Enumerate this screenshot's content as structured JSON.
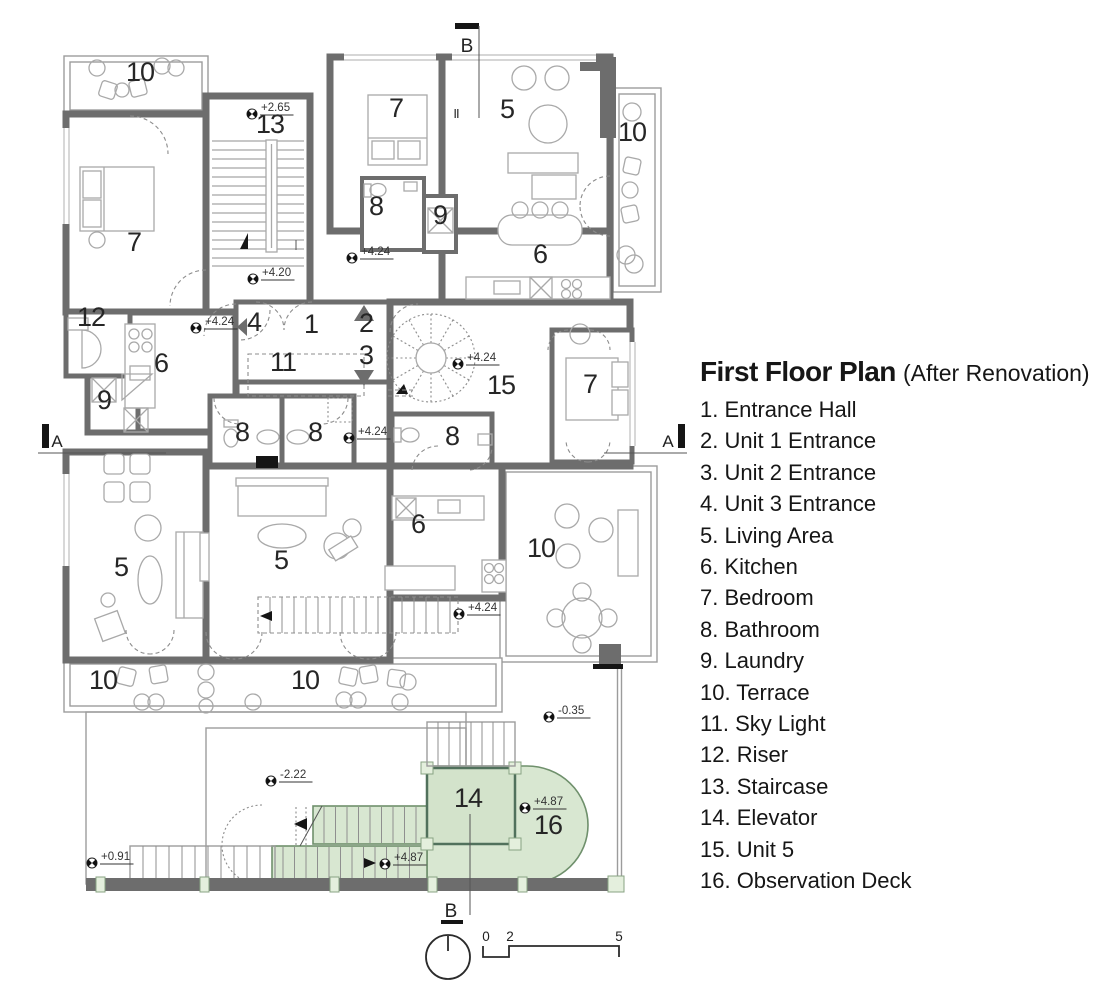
{
  "title": {
    "main": "First Floor Plan",
    "sub": "(After Renovation)"
  },
  "legend_items": [
    {
      "num": "1",
      "label": "Entrance Hall"
    },
    {
      "num": "2",
      "label": "Unit 1 Entrance"
    },
    {
      "num": "3",
      "label": "Unit 2 Entrance"
    },
    {
      "num": "4",
      "label": "Unit 3 Entrance"
    },
    {
      "num": "5",
      "label": "Living Area"
    },
    {
      "num": "6",
      "label": "Kitchen"
    },
    {
      "num": "7",
      "label": "Bedroom"
    },
    {
      "num": "8",
      "label": "Bathroom"
    },
    {
      "num": "9",
      "label": "Laundry"
    },
    {
      "num": "10",
      "label": "Terrace"
    },
    {
      "num": "11",
      "label": "Sky Light"
    },
    {
      "num": "12",
      "label": "Riser"
    },
    {
      "num": "13",
      "label": "Staircase"
    },
    {
      "num": "14",
      "label": "Elevator"
    },
    {
      "num": "15",
      "label": "Unit 5"
    },
    {
      "num": "16",
      "label": "Observation Deck"
    }
  ],
  "colors": {
    "wall": "#6d6d6d",
    "green_fill": "#d8e7d1",
    "green_line": "#6f906c",
    "text": "#161616"
  },
  "plan": {
    "room_labels": [
      {
        "t": "10",
        "x": 140,
        "y": 81
      },
      {
        "t": "13",
        "x": 270,
        "y": 133
      },
      {
        "t": "7",
        "x": 396,
        "y": 117
      },
      {
        "t": "5",
        "x": 507,
        "y": 118
      },
      {
        "t": "II",
        "x": 456,
        "y": 118,
        "s": 13
      },
      {
        "t": "10",
        "x": 632,
        "y": 141
      },
      {
        "t": "7",
        "x": 134,
        "y": 251
      },
      {
        "t": "8",
        "x": 376,
        "y": 215
      },
      {
        "t": "9",
        "x": 440,
        "y": 224
      },
      {
        "t": "6",
        "x": 540,
        "y": 263
      },
      {
        "t": "12",
        "x": 91,
        "y": 326
      },
      {
        "t": "4",
        "x": 254,
        "y": 331
      },
      {
        "t": "1",
        "x": 311,
        "y": 333
      },
      {
        "t": "2",
        "x": 366,
        "y": 332
      },
      {
        "t": "3",
        "x": 366,
        "y": 364
      },
      {
        "t": "6",
        "x": 161,
        "y": 372
      },
      {
        "t": "11",
        "x": 283,
        "y": 371
      },
      {
        "t": "9",
        "x": 104,
        "y": 409
      },
      {
        "t": "15",
        "x": 501,
        "y": 394
      },
      {
        "t": "7",
        "x": 590,
        "y": 393
      },
      {
        "t": "8",
        "x": 242,
        "y": 441
      },
      {
        "t": "8",
        "x": 315,
        "y": 441
      },
      {
        "t": "8",
        "x": 452,
        "y": 445
      },
      {
        "t": "5",
        "x": 121,
        "y": 576
      },
      {
        "t": "5",
        "x": 281,
        "y": 569
      },
      {
        "t": "6",
        "x": 418,
        "y": 533
      },
      {
        "t": "10",
        "x": 541,
        "y": 557
      },
      {
        "t": "10",
        "x": 103,
        "y": 689
      },
      {
        "t": "10",
        "x": 305,
        "y": 689
      },
      {
        "t": "14",
        "x": 468,
        "y": 807
      },
      {
        "t": "16",
        "x": 548,
        "y": 834
      }
    ],
    "level_markers": [
      {
        "t": "+2.65",
        "x": 252,
        "y": 114
      },
      {
        "t": "+4.20",
        "x": 253,
        "y": 279
      },
      {
        "t": "+4.24",
        "x": 352,
        "y": 258
      },
      {
        "t": "+4.24",
        "x": 196,
        "y": 328
      },
      {
        "t": "+4.24",
        "x": 458,
        "y": 364
      },
      {
        "t": "+4.24",
        "x": 349,
        "y": 438
      },
      {
        "t": "+4.24",
        "x": 459,
        "y": 614
      },
      {
        "t": "-0.35",
        "x": 549,
        "y": 717
      },
      {
        "t": "-2.22",
        "x": 271,
        "y": 781
      },
      {
        "t": "+0.91",
        "x": 92,
        "y": 863
      },
      {
        "t": "+4.87",
        "x": 525,
        "y": 808
      },
      {
        "t": "+4.87",
        "x": 385,
        "y": 864
      }
    ],
    "section_labels": [
      {
        "t": "B",
        "x": 467,
        "y": 52,
        "s": 19
      },
      {
        "t": "A",
        "x": 57,
        "y": 447,
        "s": 17
      },
      {
        "t": "A",
        "x": 668,
        "y": 447,
        "s": 17
      },
      {
        "t": "B",
        "x": 451,
        "y": 917,
        "s": 19
      }
    ],
    "scale_labels": [
      {
        "t": "0",
        "x": 486,
        "y": 941
      },
      {
        "t": "2",
        "x": 510,
        "y": 941
      },
      {
        "t": "5",
        "x": 619,
        "y": 941
      }
    ]
  }
}
